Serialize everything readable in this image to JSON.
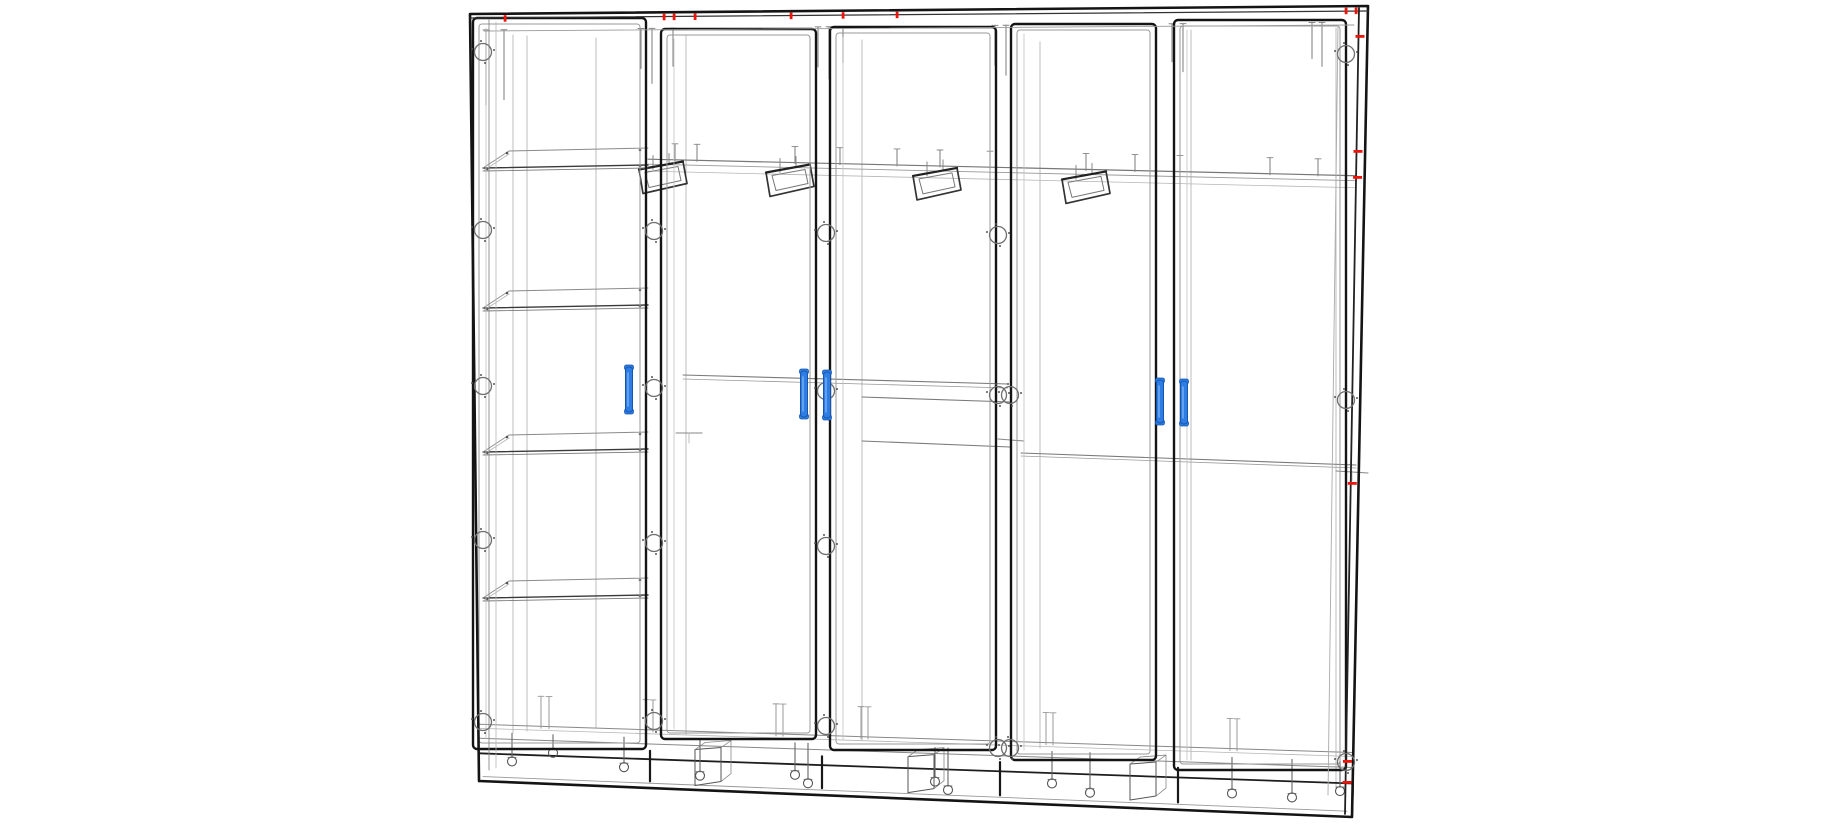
{
  "scene": {
    "subject": "Five-door wardrobe cabinet - 3D CAD wireframe drawing",
    "background": "#ffffff",
    "palette": {
      "outline": "#141414",
      "medium": "#4a4a4a",
      "thin": "#878787",
      "light": "#b6b6b6",
      "handle_fill": "#2e7de5",
      "handle_stroke": "#1457ae",
      "handle_highlight": "#7ab0f2",
      "marker_red": "#ee1409",
      "hinge": "#6f6f6f"
    }
  },
  "drawing": {
    "canvas": {
      "width": 1840,
      "height": 826
    },
    "frame": {
      "top_left": [
        470,
        14
      ],
      "top_right": [
        1368,
        6
      ],
      "bottom_right": [
        1352,
        817
      ],
      "bottom_left": [
        479,
        781
      ]
    },
    "doors": [
      {
        "id": "door-1",
        "x1": 473,
        "x2": 646,
        "top": 18,
        "bottom": 749
      },
      {
        "id": "door-2",
        "x1": 661,
        "x2": 816,
        "top": 29,
        "bottom": 739
      },
      {
        "id": "door-3",
        "x1": 830,
        "x2": 996,
        "top": 27,
        "bottom": 750
      },
      {
        "id": "door-4",
        "x1": 1011,
        "x2": 1156,
        "top": 24,
        "bottom": 760
      },
      {
        "id": "door-5",
        "x1": 1174,
        "x2": 1346,
        "top": 20,
        "bottom": 770
      }
    ],
    "handles": [
      {
        "x": 629,
        "y1": 367,
        "y2": 412
      },
      {
        "x": 804,
        "y1": 371,
        "y2": 417
      },
      {
        "x": 827,
        "y1": 372,
        "y2": 418
      },
      {
        "x": 1160,
        "y1": 380,
        "y2": 423
      },
      {
        "x": 1184,
        "y1": 381,
        "y2": 424
      }
    ],
    "shelves": {
      "x1": 483,
      "x2": 648,
      "front_y": [
        168,
        308,
        452,
        598
      ]
    },
    "hanging_rail": {
      "x1": 648,
      "x2": 1356,
      "y1": 155,
      "y2": 176,
      "support_pins": [
        675,
        697,
        795,
        840,
        897,
        940,
        990,
        1086,
        1135,
        1180,
        1270,
        1318
      ]
    },
    "coat_hooks": [
      663,
      790,
      937,
      1086
    ],
    "mid_rails": [
      {
        "x1": 683,
        "y1": 375,
        "x2": 1008,
        "y2": 384,
        "second": 4
      },
      {
        "x1": 862,
        "y1": 397,
        "x2": 1010,
        "y2": 402,
        "second": 0
      },
      {
        "x1": 862,
        "y1": 441,
        "x2": 1010,
        "y2": 447,
        "second": 0
      },
      {
        "x1": 1021,
        "y1": 453,
        "x2": 1356,
        "y2": 465,
        "second": 3
      }
    ],
    "stubs": [
      {
        "x1": 676,
        "y1": 433,
        "x2": 702,
        "y2": 433
      },
      {
        "x1": 998,
        "y1": 439,
        "x2": 1024,
        "y2": 441
      },
      {
        "x1": 1336,
        "y1": 471,
        "x2": 1368,
        "y2": 473
      }
    ],
    "hinge_columns": [
      {
        "x": 483,
        "ys": [
          52,
          230,
          386,
          540,
          722
        ]
      },
      {
        "x": 654,
        "ys": [
          231,
          388,
          543,
          721
        ]
      },
      {
        "x": 826,
        "ys": [
          233,
          391,
          546,
          726
        ]
      },
      {
        "x": 998,
        "ys": [
          235,
          395,
          748
        ]
      },
      {
        "x": 1010,
        "ys": [
          395,
          748
        ]
      },
      {
        "x": 1346,
        "ys": [
          54,
          400,
          762
        ]
      }
    ],
    "back_lines": [
      {
        "x": 513,
        "y1": 35,
        "y2": 733
      },
      {
        "x": 527,
        "y1": 36,
        "y2": 731
      },
      {
        "x": 596,
        "y1": 38,
        "y2": 728
      },
      {
        "x": 686,
        "y1": 36,
        "y2": 735
      },
      {
        "x": 862,
        "y1": 40,
        "y2": 740
      },
      {
        "x": 1040,
        "y1": 42,
        "y2": 748
      },
      {
        "x": 1191,
        "y1": 30,
        "y2": 760
      },
      {
        "x": 1336,
        "y1": 28,
        "y2": 788
      }
    ],
    "top_dowels": [
      {
        "x": 486,
        "l": 75
      },
      {
        "x": 504,
        "l": 70
      },
      {
        "x": 641,
        "l": 40
      },
      {
        "x": 652,
        "l": 55
      },
      {
        "x": 673,
        "l": 38
      },
      {
        "x": 818,
        "l": 40
      },
      {
        "x": 829,
        "l": 52
      },
      {
        "x": 843,
        "l": 36
      },
      {
        "x": 995,
        "l": 40
      },
      {
        "x": 1006,
        "l": 50
      },
      {
        "x": 1172,
        "l": 38
      },
      {
        "x": 1183,
        "l": 48
      },
      {
        "x": 1312,
        "l": 36
      },
      {
        "x": 1322,
        "l": 44
      }
    ],
    "base": {
      "corner_blocks": [
        695,
        908,
        1130
      ],
      "bottom_pins": [
        541,
        549,
        646,
        653,
        776,
        783,
        861,
        868,
        1046,
        1053,
        1230,
        1237
      ],
      "screws": [
        {
          "x": 512,
          "dy": 18
        },
        {
          "x": 553,
          "dy": 8
        },
        {
          "x": 624,
          "dy": 20
        },
        {
          "x": 700,
          "dy": 26
        },
        {
          "x": 795,
          "dy": 22
        },
        {
          "x": 808,
          "dy": 30
        },
        {
          "x": 935,
          "dy": 24
        },
        {
          "x": 948,
          "dy": 32
        },
        {
          "x": 1052,
          "dy": 22
        },
        {
          "x": 1090,
          "dy": 30
        },
        {
          "x": 1232,
          "dy": 26
        },
        {
          "x": 1292,
          "dy": 28
        },
        {
          "x": 1340,
          "dy": 20
        }
      ],
      "gap_connectors": [
        650,
        822,
        1000,
        1178
      ]
    },
    "red_marks": {
      "top_x": [
        505,
        664,
        674,
        695,
        791,
        843,
        897,
        1346,
        1356
      ],
      "right_y": [
        35,
        150,
        176,
        482,
        760,
        781
      ]
    }
  }
}
